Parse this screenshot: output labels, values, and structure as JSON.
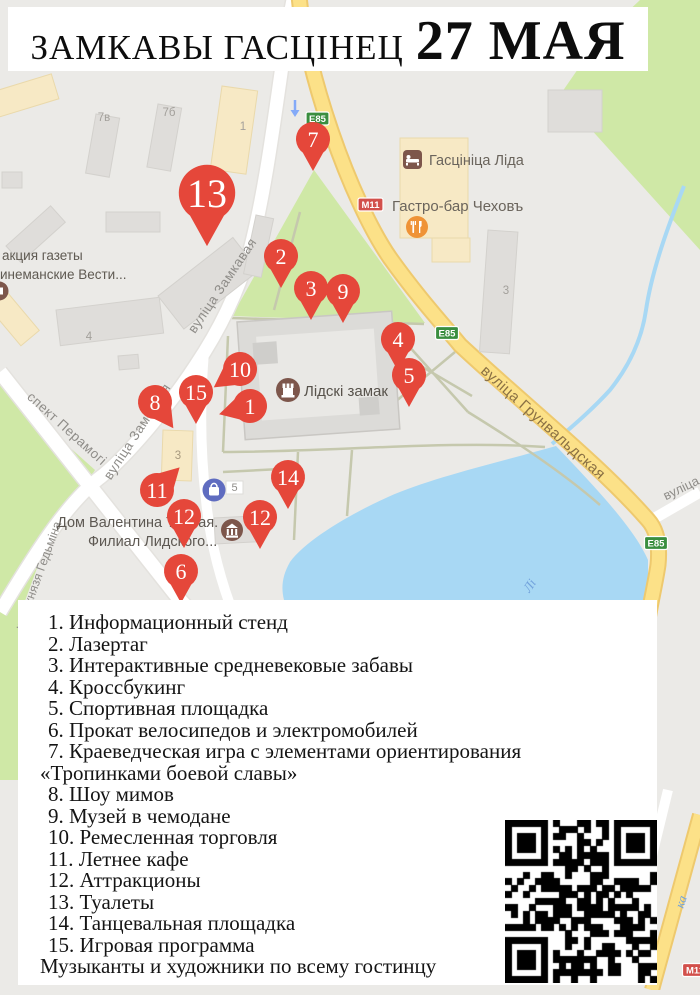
{
  "header": {
    "title": "ЗАМКАВЫ ГАСЦІНЕЦ",
    "date": "27 МАЯ"
  },
  "map": {
    "streets": [
      {
        "name": "вуліца Замкавая"
      },
      {
        "name": "вуліца Замкавая"
      },
      {
        "name": "спект Перамогі"
      },
      {
        "name": "кага князя Гедьміна"
      },
      {
        "name": "вуліца Грунвальдская"
      },
      {
        "name": "вуліца"
      }
    ],
    "route_badges": [
      {
        "label": "E85"
      },
      {
        "label": "M11"
      },
      {
        "label": "E85"
      },
      {
        "label": "E85"
      },
      {
        "label": "M11"
      }
    ],
    "building_labels": [
      "7в",
      "7б",
      "1",
      "4",
      "3",
      "5",
      "3"
    ],
    "pois": [
      {
        "label": "Гасцініца Ліда",
        "type": "hotel"
      },
      {
        "label": "Гастро-бар Чеховъ",
        "type": "restaurant"
      },
      {
        "label": "Лідскі замак",
        "type": "castle"
      },
      {
        "line1": "Дом Валентина Тавлая.",
        "line2": "Филиал Лидского...",
        "type": "museum"
      },
      {
        "line1": "акция газеты",
        "line2": "инеманские Вести...",
        "type": "newspaper"
      }
    ],
    "water_labels": [
      "Лі",
      "ка"
    ],
    "pins": [
      {
        "number": "13"
      },
      {
        "number": "7"
      },
      {
        "number": "2"
      },
      {
        "number": "9"
      },
      {
        "number": "3"
      },
      {
        "number": "4"
      },
      {
        "number": "5"
      },
      {
        "number": "10"
      },
      {
        "number": "15"
      },
      {
        "number": "1"
      },
      {
        "number": "8"
      },
      {
        "number": "11"
      },
      {
        "number": "14"
      },
      {
        "number": "12"
      },
      {
        "number": "12"
      },
      {
        "number": "6"
      }
    ]
  },
  "legend": {
    "items": [
      "1. Информационный стенд",
      "2. Лазертаг",
      "3. Интерактивные средневековые забавы",
      "4. Кроссбукинг",
      "5. Спортивная площадка",
      "6. Прокат велосипедов и электромобилей",
      "7. Краеведческая игра с элементами ориентирования",
      "«Тропинками боевой славы»",
      "8. Шоу мимов",
      "9. Музей в чемодане",
      "10. Ремесленная торговля",
      "11. Летнее кафе",
      "12. Аттракционы",
      "13. Туалеты",
      "14. Танцевальная площадка",
      "15. Игровая программа"
    ],
    "footer": "Музыканты и художники по всему гостинцу"
  },
  "colors": {
    "pin_red": "#e5473a",
    "park_green": "#cfe8a6",
    "water_blue": "#a8d8f4",
    "road_yellow": "#fce188",
    "badge_green": "#3a8e3f",
    "badge_red": "#d2504b",
    "poi_brown": "#7d564b",
    "poi_orange": "#ef9336",
    "poi_blue": "#5f6cc0"
  }
}
